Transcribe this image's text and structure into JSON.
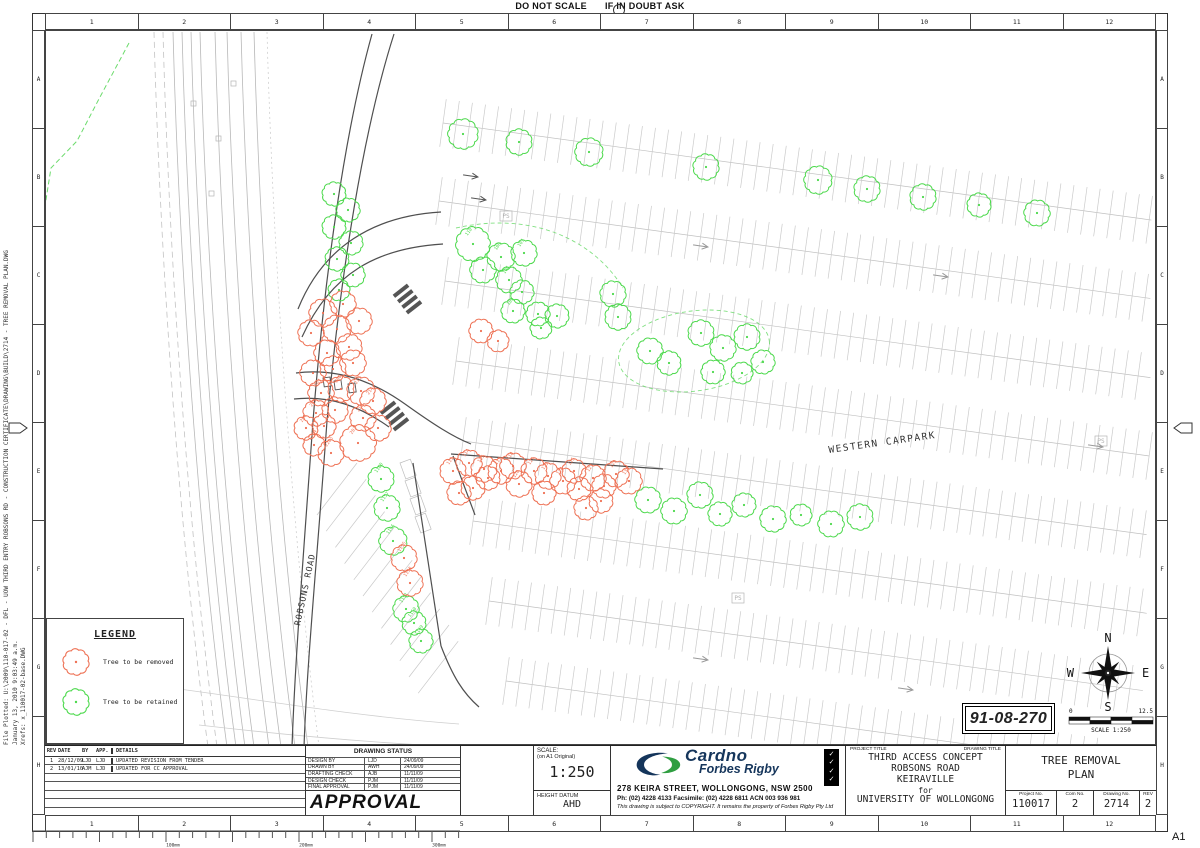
{
  "sheet": {
    "note_left": "DO NOT SCALE",
    "note_right": "IF IN DOUBT ASK",
    "size_label": "A1",
    "grid_numbers": [
      "1",
      "2",
      "3",
      "4",
      "5",
      "6",
      "7",
      "8",
      "9",
      "10",
      "11",
      "12"
    ],
    "grid_letters": [
      "A",
      "B",
      "C",
      "D",
      "E",
      "F",
      "G",
      "H"
    ],
    "plot_line1": "File Plotted: U:\\2009\\110-017-02 - DFL - UOW THIRD ENTRY ROBSONS RD - CONSTRUCTION CERTIFICATE\\DRAWING\\BUILD\\2714 - TREE REMOVAL PLAN.DWG",
    "plot_line2": "January 13, 2010 9:03:49 a.m.",
    "plot_line3": "Xrefs: x_110017-02-base.DWG",
    "ruler_labels": [
      "100mm",
      "200mm",
      "300mm"
    ]
  },
  "legend": {
    "title": "LEGEND",
    "items": [
      {
        "label": "Tree to be removed",
        "color": "#ee7154"
      },
      {
        "label": "Tree to be retained",
        "color": "#4cd94c"
      }
    ]
  },
  "badge": {
    "number": "91-08-270"
  },
  "compass": {
    "n": "N",
    "e": "E",
    "s": "S",
    "w": "W"
  },
  "scale_bar": {
    "left": "0",
    "right": "12.5",
    "label": "SCALE 1:250"
  },
  "plan": {
    "carpark_label": "WESTERN CARPARK",
    "road_label": "ROBSONS ROAD",
    "ps_label": "PS",
    "removed_color": "#ee7154",
    "retained_color": "#4cd94c",
    "boundary_color": "#6cdb6c",
    "trees_retained": [
      [
        462,
        133,
        14
      ],
      [
        518,
        141,
        12
      ],
      [
        588,
        151,
        13
      ],
      [
        705,
        166,
        12
      ],
      [
        817,
        179,
        13
      ],
      [
        866,
        188,
        12
      ],
      [
        922,
        196,
        12
      ],
      [
        978,
        204,
        11
      ],
      [
        1036,
        212,
        12
      ],
      [
        333,
        193,
        11
      ],
      [
        347,
        209,
        11
      ],
      [
        333,
        226,
        11
      ],
      [
        350,
        242,
        11
      ],
      [
        336,
        258,
        11
      ],
      [
        352,
        274,
        11
      ],
      [
        338,
        289,
        10
      ],
      [
        472,
        243,
        16,
        "110"
      ],
      [
        500,
        256,
        13,
        "108"
      ],
      [
        482,
        269,
        12
      ],
      [
        523,
        252,
        12,
        "107"
      ],
      [
        508,
        279,
        12,
        "106"
      ],
      [
        521,
        291,
        11
      ],
      [
        512,
        310,
        11,
        "105"
      ],
      [
        537,
        313,
        11
      ],
      [
        556,
        315,
        11
      ],
      [
        540,
        327,
        10
      ],
      [
        612,
        293,
        12
      ],
      [
        617,
        316,
        12
      ],
      [
        649,
        350,
        12
      ],
      [
        668,
        362,
        11
      ],
      [
        700,
        332,
        12
      ],
      [
        722,
        347,
        12
      ],
      [
        746,
        336,
        12
      ],
      [
        712,
        371,
        11
      ],
      [
        762,
        361,
        11
      ],
      [
        741,
        372,
        10
      ],
      [
        647,
        499,
        12
      ],
      [
        673,
        510,
        12
      ],
      [
        699,
        494,
        12
      ],
      [
        719,
        513,
        11
      ],
      [
        743,
        504,
        11
      ],
      [
        772,
        518,
        12
      ],
      [
        800,
        514,
        10
      ],
      [
        830,
        523,
        12
      ],
      [
        859,
        516,
        12
      ],
      [
        380,
        478,
        12,
        "1160"
      ],
      [
        386,
        507,
        12,
        "1157"
      ],
      [
        392,
        540,
        13,
        "1156"
      ],
      [
        405,
        608,
        12,
        "1151"
      ],
      [
        413,
        622,
        11,
        "1150"
      ],
      [
        420,
        640,
        11,
        "1149"
      ]
    ],
    "trees_removed": [
      [
        322,
        312,
        13
      ],
      [
        342,
        303,
        12
      ],
      [
        310,
        332,
        12
      ],
      [
        336,
        328,
        13
      ],
      [
        358,
        320,
        12
      ],
      [
        326,
        352,
        12
      ],
      [
        348,
        346,
        12
      ],
      [
        312,
        372,
        12
      ],
      [
        332,
        368,
        12
      ],
      [
        352,
        362,
        12
      ],
      [
        320,
        392,
        12,
        "207"
      ],
      [
        340,
        388,
        12,
        "206"
      ],
      [
        360,
        390,
        13,
        "215"
      ],
      [
        372,
        400,
        12,
        "214"
      ],
      [
        315,
        412,
        12,
        "205"
      ],
      [
        334,
        409,
        12
      ],
      [
        362,
        417,
        12,
        "216"
      ],
      [
        377,
        427,
        12
      ],
      [
        305,
        427,
        11,
        "204"
      ],
      [
        323,
        425,
        11
      ],
      [
        357,
        442,
        17,
        "203"
      ],
      [
        330,
        452,
        12,
        "2203"
      ],
      [
        313,
        444,
        10,
        "2204"
      ],
      [
        452,
        470,
        12,
        "113"
      ],
      [
        468,
        462,
        12,
        "114"
      ],
      [
        483,
        468,
        12,
        "115"
      ],
      [
        472,
        487,
        11
      ],
      [
        458,
        492,
        11
      ],
      [
        487,
        477,
        11
      ],
      [
        500,
        470,
        12,
        "117"
      ],
      [
        512,
        465,
        12,
        "118"
      ],
      [
        518,
        483,
        12,
        "120"
      ],
      [
        533,
        470,
        12,
        "121"
      ],
      [
        547,
        475,
        12,
        "123"
      ],
      [
        543,
        492,
        11
      ],
      [
        562,
        480,
        12,
        "124"
      ],
      [
        573,
        470,
        11,
        "125"
      ],
      [
        578,
        488,
        11
      ],
      [
        592,
        477,
        12,
        "127"
      ],
      [
        603,
        485,
        11
      ],
      [
        615,
        473,
        12,
        "129"
      ],
      [
        628,
        480,
        12,
        "130"
      ],
      [
        600,
        500,
        11
      ],
      [
        585,
        507,
        11
      ],
      [
        403,
        557,
        12,
        "1155"
      ],
      [
        409,
        582,
        12,
        "1153"
      ],
      [
        480,
        330,
        11
      ],
      [
        497,
        340,
        10
      ]
    ]
  },
  "revision_table": {
    "headers": [
      "REV",
      "DATE",
      "BY",
      "APP.",
      "DETAILS"
    ],
    "rows": [
      [
        "1",
        "28/12/09",
        "LJD",
        "LJD",
        "UPDATED  REVISION  FROM  TENDER"
      ],
      [
        "2",
        "13/01/10",
        "AJM",
        "LJD",
        "UPDATED  FOR  CC  APPROVAL"
      ]
    ],
    "empty_rows": 5
  },
  "drawing_status": {
    "title": "DRAWING STATUS",
    "rows": [
      [
        "DESIGN BY",
        "LJD",
        "24/09/09"
      ],
      [
        "DRAWN BY",
        "AWH",
        "24/09/09"
      ],
      [
        "DRAFTING CHECK",
        "AJB",
        "11/11/09"
      ],
      [
        "DESIGN CHECK",
        "PJM",
        "11/11/09"
      ],
      [
        "FINAL APPROVAL",
        "PJM",
        "11/11/09"
      ]
    ],
    "stamp": "APPROVAL"
  },
  "scale_box": {
    "label": "SCALE:",
    "sub": "(on A1 Original)",
    "value": "1:250",
    "datum_label": "HEIGHT DATUM",
    "datum_value": "AHD"
  },
  "company": {
    "name_top": "Cardno",
    "name_bottom": "Forbes Rigby",
    "address": "278 KEIRA STREET, WOLLONGONG, NSW 2500",
    "phone_line": "Ph: (02) 4228 4133   Facsimile: (02) 4228 6811   ACN 003 936 981",
    "copyright": "This drawing is subject to COPYRIGHT. It remains the property of Forbes Rigby Pty Ltd",
    "brand_navy": "#15355b",
    "brand_green": "#2f9e41"
  },
  "title_block": {
    "project_title_label": "PROJECT TITLE",
    "drawing_title_label": "DRAWING TITLE",
    "project_line1": "THIRD  ACCESS  CONCEPT",
    "project_line2": "ROBSONS  ROAD",
    "project_line3": "KEIRAVILLE",
    "project_line4": "for",
    "project_line5": "UNIVERSITY  OF  WOLLONGONG",
    "drawing_line1": "TREE  REMOVAL",
    "drawing_line2": "PLAN",
    "project_no_label": "Project No.",
    "project_no": "110017",
    "com_no_label": "Com No.",
    "com_no": "2",
    "drawing_no_label": "Drawing No.",
    "drawing_no": "2714",
    "rev_label": "REV",
    "rev": "2"
  }
}
